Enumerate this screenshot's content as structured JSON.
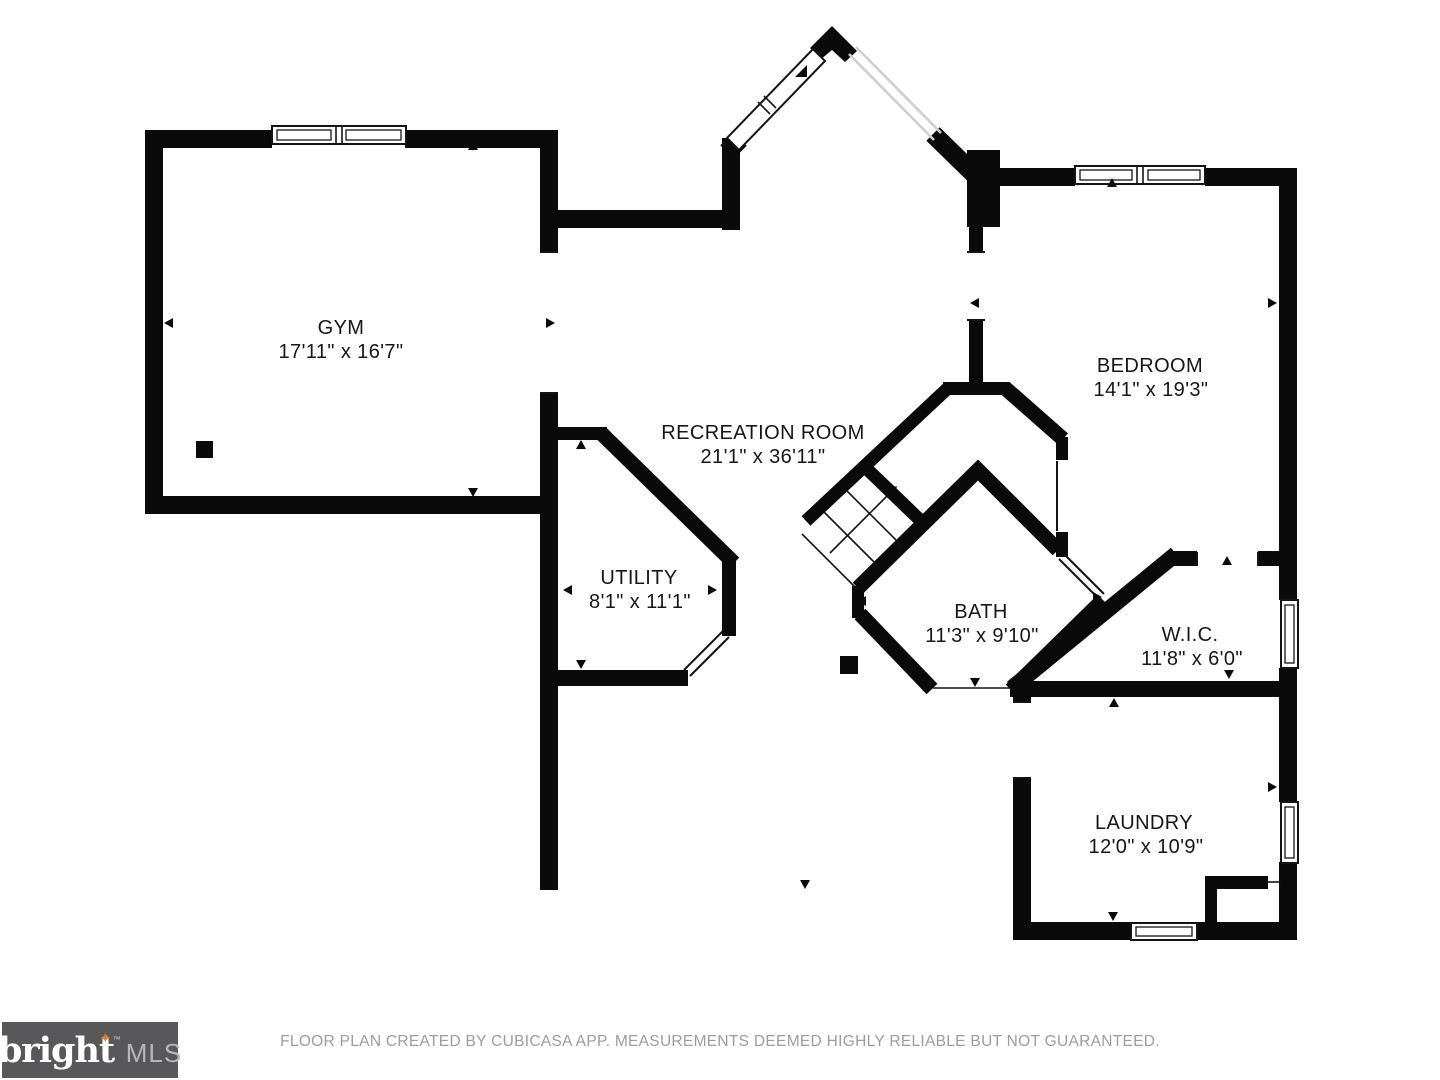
{
  "plan": {
    "type": "floor-plan",
    "wall_color": "#0a0a0a",
    "rooms": [
      {
        "id": "gym",
        "name": "GYM",
        "dims": "17'11\" x 16'7\""
      },
      {
        "id": "recreation-room",
        "name": "RECREATION ROOM",
        "dims": "21'1\" x 36'11\""
      },
      {
        "id": "bedroom",
        "name": "BEDROOM",
        "dims": "14'1\" x 19'3\""
      },
      {
        "id": "utility",
        "name": "UTILITY",
        "dims": "8'1\" x 11'1\""
      },
      {
        "id": "bath",
        "name": "BATH",
        "dims": "11'3\" x 9'10\""
      },
      {
        "id": "wic",
        "name": "W.I.C.",
        "dims": "11'8\" x 6'0\""
      },
      {
        "id": "laundry",
        "name": "LAUNDRY",
        "dims": "12'0\" x 10'9\""
      }
    ]
  },
  "branding": {
    "logo_text": "bright",
    "logo_star": "✦",
    "logo_tm": "™",
    "logo_suffix": "MLS",
    "logo_bg": "#58585a",
    "star_color": "#e87a2e"
  },
  "footer": {
    "disclaimer": "FLOOR PLAN CREATED BY CUBICASA APP. MEASUREMENTS DEEMED HIGHLY RELIABLE BUT NOT GUARANTEED."
  }
}
